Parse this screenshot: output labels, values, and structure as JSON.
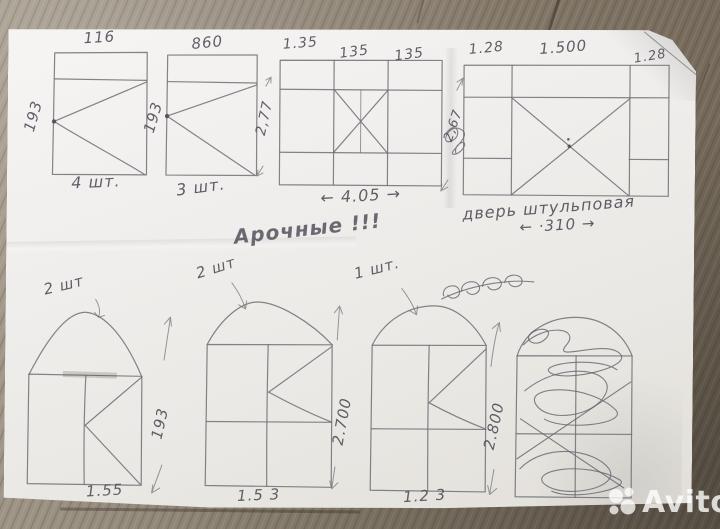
{
  "note": {
    "arched": "Арочные !!!"
  },
  "top": {
    "w1": {
      "width": "116",
      "height": "193",
      "count": "4 шт."
    },
    "w2": {
      "width": "860",
      "height": "193",
      "count": "3 шт."
    },
    "w3": {
      "w_left": "1.35",
      "w_mid": "135",
      "w_right": "135",
      "height": "2,77",
      "total": "← 4.05 →"
    },
    "gap": {
      "height": "2,67"
    },
    "door": {
      "w_left": "1.28",
      "w_mid": "1.500",
      "w_right": "1.28",
      "caption": "дверь штульповая",
      "total": "← ·310 →"
    }
  },
  "bottom": {
    "a1": {
      "count": "2 шт",
      "height": "193",
      "width": "1.55"
    },
    "a2": {
      "count": "2 шт",
      "height": "2.700",
      "width": "1.5 3"
    },
    "a3": {
      "count": "1 шт.",
      "height": "2.800",
      "width": "1.2 3"
    }
  },
  "watermark": {
    "brand": "Avito",
    "logo": "avito-circles-logo"
  }
}
